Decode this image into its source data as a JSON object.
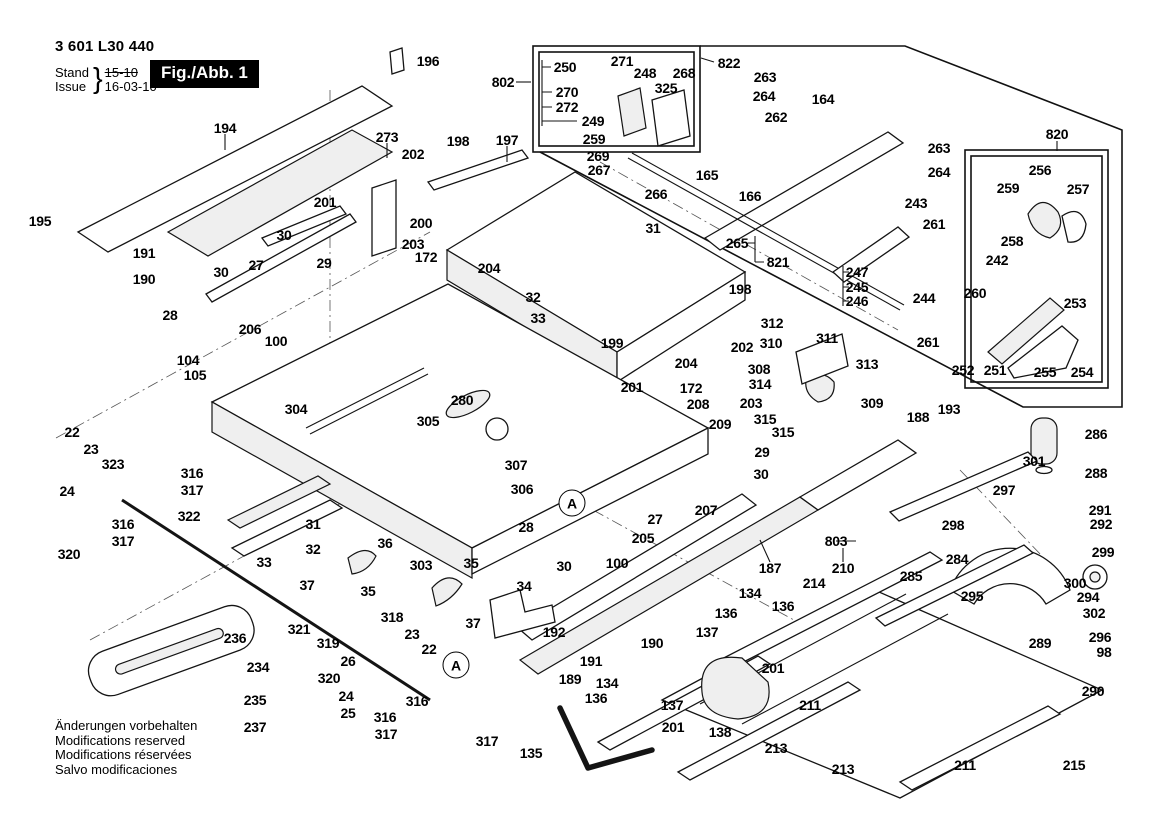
{
  "doc": {
    "part_number": "3 601 L30 440",
    "stand_label": "Stand",
    "issue_label": "Issue",
    "stand_value": "15-10",
    "issue_value": "16-03-10",
    "brace": "}",
    "figure_label": "Fig./Abb. 1",
    "footer_lines": [
      "Änderungen vorbehalten",
      "Modifications reserved",
      "Modifications réservées",
      "Salvo modificaciones"
    ]
  },
  "diagram": {
    "circled_markers": [
      {
        "text": "A",
        "x": 572,
        "y": 503
      },
      {
        "text": "A",
        "x": 456,
        "y": 665
      }
    ],
    "part_labels": [
      {
        "t": "194",
        "x": 225,
        "y": 128
      },
      {
        "t": "196",
        "x": 428,
        "y": 61
      },
      {
        "t": "195",
        "x": 40,
        "y": 221
      },
      {
        "t": "191",
        "x": 144,
        "y": 253
      },
      {
        "t": "190",
        "x": 144,
        "y": 279
      },
      {
        "t": "273",
        "x": 387,
        "y": 137
      },
      {
        "t": "202",
        "x": 413,
        "y": 154
      },
      {
        "t": "198",
        "x": 458,
        "y": 141
      },
      {
        "t": "197",
        "x": 507,
        "y": 140
      },
      {
        "t": "201",
        "x": 325,
        "y": 202
      },
      {
        "t": "30",
        "x": 284,
        "y": 235
      },
      {
        "t": "29",
        "x": 324,
        "y": 263
      },
      {
        "t": "27",
        "x": 256,
        "y": 265
      },
      {
        "t": "30",
        "x": 221,
        "y": 272
      },
      {
        "t": "200",
        "x": 421,
        "y": 223
      },
      {
        "t": "203",
        "x": 413,
        "y": 244
      },
      {
        "t": "172",
        "x": 426,
        "y": 257
      },
      {
        "t": "204",
        "x": 489,
        "y": 268
      },
      {
        "t": "28",
        "x": 170,
        "y": 315
      },
      {
        "t": "206",
        "x": 250,
        "y": 329
      },
      {
        "t": "100",
        "x": 276,
        "y": 341
      },
      {
        "t": "104",
        "x": 188,
        "y": 360
      },
      {
        "t": "105",
        "x": 195,
        "y": 375
      },
      {
        "t": "304",
        "x": 296,
        "y": 409
      },
      {
        "t": "305",
        "x": 428,
        "y": 421
      },
      {
        "t": "280",
        "x": 462,
        "y": 400
      },
      {
        "t": "307",
        "x": 516,
        "y": 465
      },
      {
        "t": "306",
        "x": 522,
        "y": 489
      },
      {
        "t": "303",
        "x": 421,
        "y": 565
      },
      {
        "t": "802",
        "x": 503,
        "y": 82
      },
      {
        "t": "250",
        "x": 565,
        "y": 67
      },
      {
        "t": "271",
        "x": 622,
        "y": 61
      },
      {
        "t": "248",
        "x": 645,
        "y": 73
      },
      {
        "t": "268",
        "x": 684,
        "y": 73
      },
      {
        "t": "822",
        "x": 729,
        "y": 63
      },
      {
        "t": "325",
        "x": 666,
        "y": 88
      },
      {
        "t": "270",
        "x": 567,
        "y": 92
      },
      {
        "t": "272",
        "x": 567,
        "y": 107
      },
      {
        "t": "249",
        "x": 593,
        "y": 121
      },
      {
        "t": "259",
        "x": 594,
        "y": 139
      },
      {
        "t": "269",
        "x": 598,
        "y": 156
      },
      {
        "t": "267",
        "x": 599,
        "y": 170
      },
      {
        "t": "266",
        "x": 656,
        "y": 194
      },
      {
        "t": "263",
        "x": 765,
        "y": 77
      },
      {
        "t": "264",
        "x": 764,
        "y": 96
      },
      {
        "t": "164",
        "x": 823,
        "y": 99
      },
      {
        "t": "262",
        "x": 776,
        "y": 117
      },
      {
        "t": "165",
        "x": 707,
        "y": 175
      },
      {
        "t": "166",
        "x": 750,
        "y": 196
      },
      {
        "t": "31",
        "x": 653,
        "y": 228
      },
      {
        "t": "265",
        "x": 737,
        "y": 243
      },
      {
        "t": "821",
        "x": 778,
        "y": 262
      },
      {
        "t": "820",
        "x": 1057,
        "y": 134
      },
      {
        "t": "263",
        "x": 939,
        "y": 148
      },
      {
        "t": "264",
        "x": 939,
        "y": 172
      },
      {
        "t": "256",
        "x": 1040,
        "y": 170
      },
      {
        "t": "259",
        "x": 1008,
        "y": 188
      },
      {
        "t": "257",
        "x": 1078,
        "y": 189
      },
      {
        "t": "243",
        "x": 916,
        "y": 203
      },
      {
        "t": "261",
        "x": 934,
        "y": 224
      },
      {
        "t": "258",
        "x": 1012,
        "y": 241
      },
      {
        "t": "242",
        "x": 997,
        "y": 260
      },
      {
        "t": "247",
        "x": 857,
        "y": 272
      },
      {
        "t": "245",
        "x": 857,
        "y": 287
      },
      {
        "t": "246",
        "x": 857,
        "y": 301
      },
      {
        "t": "244",
        "x": 924,
        "y": 298
      },
      {
        "t": "260",
        "x": 975,
        "y": 293
      },
      {
        "t": "253",
        "x": 1075,
        "y": 303
      },
      {
        "t": "261",
        "x": 928,
        "y": 342
      },
      {
        "t": "252",
        "x": 963,
        "y": 370
      },
      {
        "t": "251",
        "x": 995,
        "y": 370
      },
      {
        "t": "255",
        "x": 1045,
        "y": 372
      },
      {
        "t": "254",
        "x": 1082,
        "y": 372
      },
      {
        "t": "312",
        "x": 772,
        "y": 323
      },
      {
        "t": "310",
        "x": 771,
        "y": 343
      },
      {
        "t": "311",
        "x": 827,
        "y": 338
      },
      {
        "t": "313",
        "x": 867,
        "y": 364
      },
      {
        "t": "308",
        "x": 759,
        "y": 369
      },
      {
        "t": "314",
        "x": 760,
        "y": 384
      },
      {
        "t": "309",
        "x": 872,
        "y": 403
      },
      {
        "t": "315",
        "x": 765,
        "y": 419
      },
      {
        "t": "315",
        "x": 783,
        "y": 432
      },
      {
        "t": "202",
        "x": 742,
        "y": 347
      },
      {
        "t": "203",
        "x": 751,
        "y": 403
      },
      {
        "t": "208",
        "x": 698,
        "y": 404
      },
      {
        "t": "209",
        "x": 720,
        "y": 424
      },
      {
        "t": "198",
        "x": 740,
        "y": 289
      },
      {
        "t": "199",
        "x": 612,
        "y": 343
      },
      {
        "t": "201",
        "x": 632,
        "y": 387
      },
      {
        "t": "204",
        "x": 686,
        "y": 363
      },
      {
        "t": "172",
        "x": 691,
        "y": 388
      },
      {
        "t": "32",
        "x": 533,
        "y": 297
      },
      {
        "t": "33",
        "x": 538,
        "y": 318
      },
      {
        "t": "29",
        "x": 762,
        "y": 452
      },
      {
        "t": "30",
        "x": 761,
        "y": 474
      },
      {
        "t": "27",
        "x": 655,
        "y": 519
      },
      {
        "t": "205",
        "x": 643,
        "y": 538
      },
      {
        "t": "100",
        "x": 617,
        "y": 563
      },
      {
        "t": "30",
        "x": 564,
        "y": 566
      },
      {
        "t": "28",
        "x": 526,
        "y": 527
      },
      {
        "t": "207",
        "x": 706,
        "y": 510
      },
      {
        "t": "187",
        "x": 770,
        "y": 568
      },
      {
        "t": "803",
        "x": 836,
        "y": 541
      },
      {
        "t": "210",
        "x": 843,
        "y": 568
      },
      {
        "t": "214",
        "x": 814,
        "y": 583
      },
      {
        "t": "188",
        "x": 918,
        "y": 417
      },
      {
        "t": "193",
        "x": 949,
        "y": 409
      },
      {
        "t": "301",
        "x": 1034,
        "y": 461
      },
      {
        "t": "286",
        "x": 1096,
        "y": 434
      },
      {
        "t": "288",
        "x": 1096,
        "y": 473
      },
      {
        "t": "297",
        "x": 1004,
        "y": 490
      },
      {
        "t": "298",
        "x": 953,
        "y": 525
      },
      {
        "t": "291",
        "x": 1100,
        "y": 510
      },
      {
        "t": "292",
        "x": 1101,
        "y": 524
      },
      {
        "t": "284",
        "x": 957,
        "y": 559
      },
      {
        "t": "299",
        "x": 1103,
        "y": 552
      },
      {
        "t": "300",
        "x": 1075,
        "y": 583
      },
      {
        "t": "294",
        "x": 1088,
        "y": 597
      },
      {
        "t": "302",
        "x": 1094,
        "y": 613
      },
      {
        "t": "296",
        "x": 1100,
        "y": 637
      },
      {
        "t": "98",
        "x": 1104,
        "y": 652
      },
      {
        "t": "289",
        "x": 1040,
        "y": 643
      },
      {
        "t": "290",
        "x": 1093,
        "y": 691
      },
      {
        "t": "295",
        "x": 972,
        "y": 596
      },
      {
        "t": "285",
        "x": 911,
        "y": 576
      },
      {
        "t": "134",
        "x": 750,
        "y": 593
      },
      {
        "t": "136",
        "x": 783,
        "y": 606
      },
      {
        "t": "136",
        "x": 726,
        "y": 613
      },
      {
        "t": "137",
        "x": 707,
        "y": 632
      },
      {
        "t": "190",
        "x": 652,
        "y": 643
      },
      {
        "t": "191",
        "x": 591,
        "y": 661
      },
      {
        "t": "189",
        "x": 570,
        "y": 679
      },
      {
        "t": "192",
        "x": 554,
        "y": 632
      },
      {
        "t": "134",
        "x": 607,
        "y": 683
      },
      {
        "t": "136",
        "x": 596,
        "y": 698
      },
      {
        "t": "137",
        "x": 672,
        "y": 705
      },
      {
        "t": "201",
        "x": 773,
        "y": 668
      },
      {
        "t": "201",
        "x": 673,
        "y": 727
      },
      {
        "t": "138",
        "x": 720,
        "y": 732
      },
      {
        "t": "211",
        "x": 810,
        "y": 705
      },
      {
        "t": "213",
        "x": 776,
        "y": 748
      },
      {
        "t": "213",
        "x": 843,
        "y": 769
      },
      {
        "t": "211",
        "x": 965,
        "y": 765
      },
      {
        "t": "215",
        "x": 1074,
        "y": 765
      },
      {
        "t": "135",
        "x": 531,
        "y": 753
      },
      {
        "t": "36",
        "x": 385,
        "y": 543
      },
      {
        "t": "35",
        "x": 471,
        "y": 563
      },
      {
        "t": "34",
        "x": 524,
        "y": 586
      },
      {
        "t": "37",
        "x": 473,
        "y": 623
      },
      {
        "t": "35",
        "x": 368,
        "y": 591
      },
      {
        "t": "37",
        "x": 307,
        "y": 585
      },
      {
        "t": "318",
        "x": 392,
        "y": 617
      },
      {
        "t": "319",
        "x": 328,
        "y": 643
      },
      {
        "t": "23",
        "x": 412,
        "y": 634
      },
      {
        "t": "22",
        "x": 429,
        "y": 649
      },
      {
        "t": "26",
        "x": 348,
        "y": 661
      },
      {
        "t": "320",
        "x": 329,
        "y": 678
      },
      {
        "t": "24",
        "x": 346,
        "y": 696
      },
      {
        "t": "25",
        "x": 348,
        "y": 713
      },
      {
        "t": "316",
        "x": 417,
        "y": 701
      },
      {
        "t": "316",
        "x": 385,
        "y": 717
      },
      {
        "t": "317",
        "x": 386,
        "y": 734
      },
      {
        "t": "317",
        "x": 487,
        "y": 741
      },
      {
        "t": "321",
        "x": 299,
        "y": 629
      },
      {
        "t": "236",
        "x": 235,
        "y": 638
      },
      {
        "t": "234",
        "x": 258,
        "y": 667
      },
      {
        "t": "235",
        "x": 255,
        "y": 700
      },
      {
        "t": "237",
        "x": 255,
        "y": 727
      },
      {
        "t": "22",
        "x": 72,
        "y": 432
      },
      {
        "t": "23",
        "x": 91,
        "y": 449
      },
      {
        "t": "323",
        "x": 113,
        "y": 464
      },
      {
        "t": "316",
        "x": 192,
        "y": 473
      },
      {
        "t": "317",
        "x": 192,
        "y": 490
      },
      {
        "t": "24",
        "x": 67,
        "y": 491
      },
      {
        "t": "316",
        "x": 123,
        "y": 524
      },
      {
        "t": "317",
        "x": 123,
        "y": 541
      },
      {
        "t": "320",
        "x": 69,
        "y": 554
      },
      {
        "t": "322",
        "x": 189,
        "y": 516
      },
      {
        "t": "31",
        "x": 313,
        "y": 524
      },
      {
        "t": "32",
        "x": 313,
        "y": 549
      },
      {
        "t": "33",
        "x": 264,
        "y": 562
      }
    ]
  }
}
